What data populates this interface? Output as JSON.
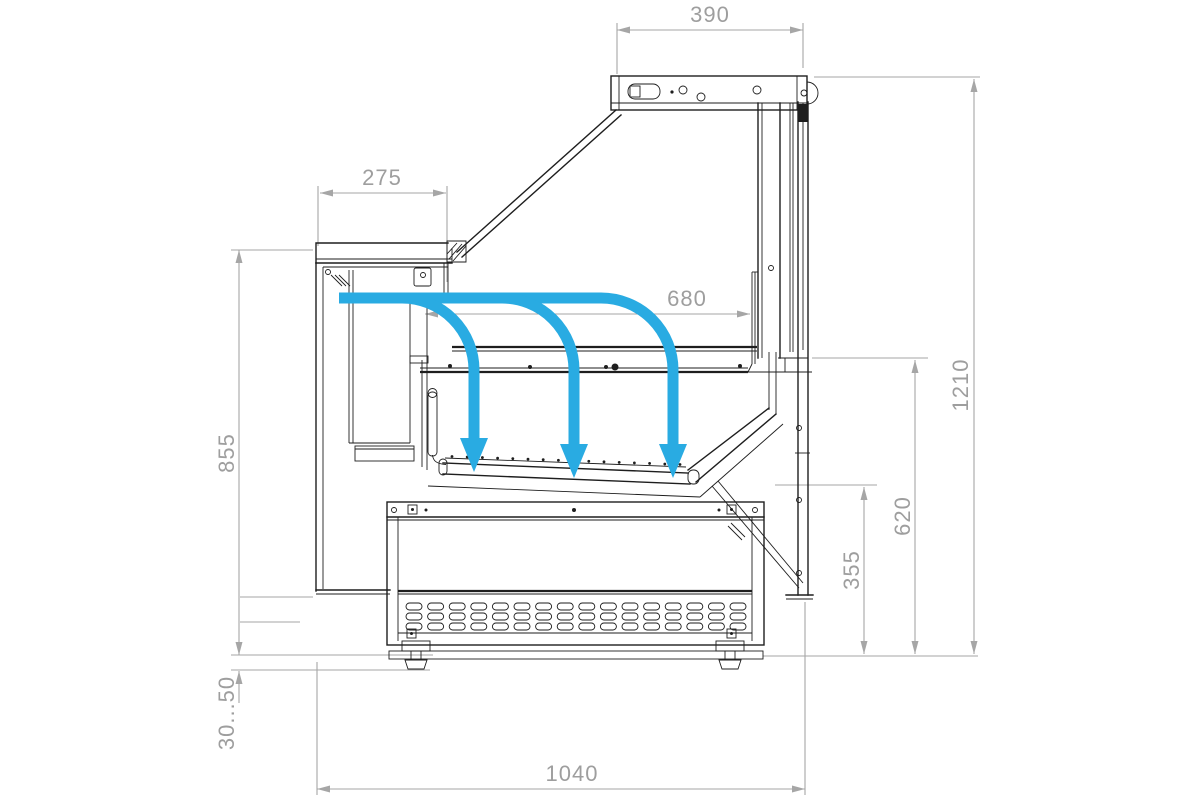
{
  "title": "Refrigerated display counter — side cross-section drawing",
  "colors": {
    "drawing_line": "#1e1e1e",
    "dimension_line": "#a6a6a6",
    "dimension_text": "#9e9e9e",
    "airflow_accent": "#29ABE2",
    "background": "#ffffff"
  },
  "dimensions": {
    "top_width": {
      "label": "390"
    },
    "counter_depth": {
      "label": "275"
    },
    "glass_span": {
      "label": "680"
    },
    "counter_height": {
      "label": "855"
    },
    "foot_adjust": {
      "label": "30...50"
    },
    "total_height": {
      "label": "1210"
    },
    "front_height": {
      "label": "620"
    },
    "well_height": {
      "label": "355"
    },
    "total_depth": {
      "label": "1040"
    }
  },
  "airflow": {
    "arrow_count": 3,
    "direction": "down-into-well"
  }
}
